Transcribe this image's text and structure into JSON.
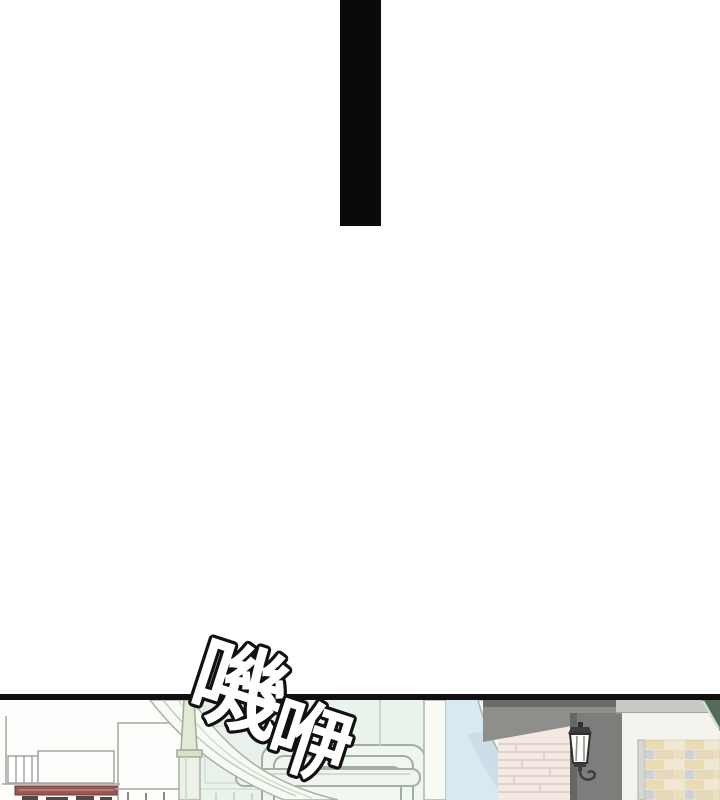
{
  "sfx": {
    "text": "嘰咿",
    "char1": "嘰",
    "char2": "咿"
  },
  "colors": {
    "paper": "#ffffff",
    "bar_black": "#0a0a0a",
    "line_black": "#101010",
    "panel_bg": "#fdfdfb",
    "outline_gray": "#a5a5a1",
    "glass_green": "#e3eee7",
    "glass_blue": "#d8e9f1",
    "glass_shade": "#c5d8e4",
    "frame_light": "#f8faf4",
    "frame_outline": "#a8b2a6",
    "panel_frame_line": "#9fb0a2",
    "spire_green": "#e0ead6",
    "spire_cap": "#d6e2ca",
    "brick_pink": "#f4e9e3",
    "brick_pink_line": "#dcc8c2",
    "brick_tan": "#eadcb2",
    "brick_cream": "#f1e8d3",
    "brick_bluegray": "#cdd2d9",
    "beige_wall": "#efe5c9",
    "awning_gray": "#8e8e8a",
    "awning_dark": "#6b6b67",
    "pillar_gray": "#7d7d7b",
    "pillar_shade": "#666664",
    "ledge_gray": "#c8c8c4",
    "wall_white": "#f5f3ee",
    "teal_accent": "#566a5c",
    "teal_edge": "#cfe3c5",
    "red_ledge": "#9b5653",
    "lamp_dark": "#3c3c3c",
    "lamp_glass": "#fbfbf9"
  }
}
